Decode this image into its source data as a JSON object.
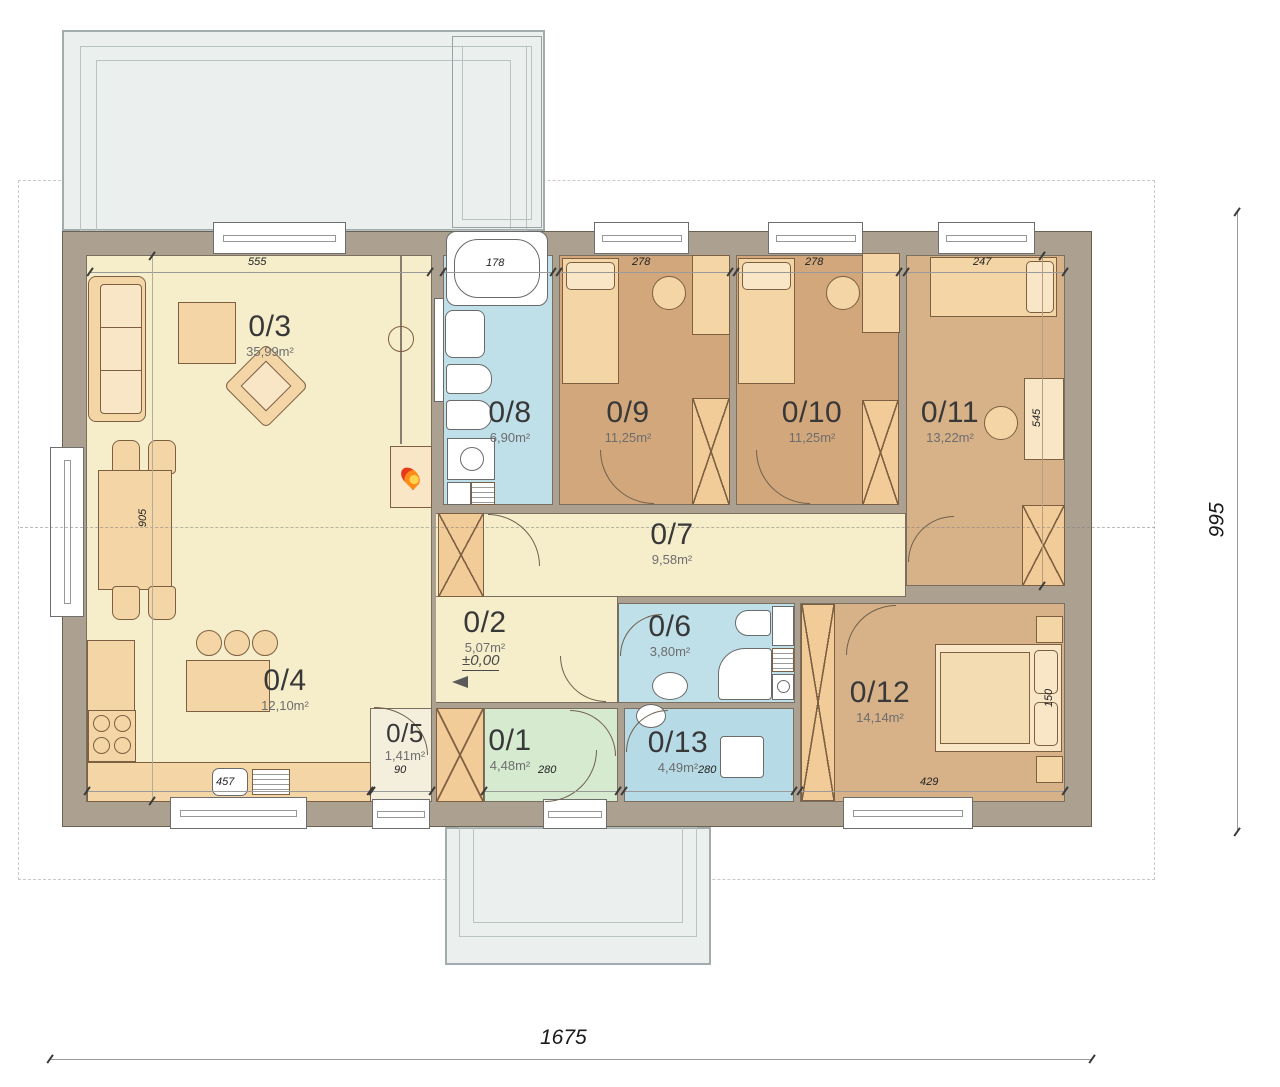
{
  "plan": {
    "title": "Single-storey house floor plan",
    "rooms": [
      {
        "id": "0/1",
        "area": "4,48m²",
        "type": "entry"
      },
      {
        "id": "0/2",
        "area": "5,07m²",
        "type": "hall"
      },
      {
        "id": "0/3",
        "area": "35,99m²",
        "type": "living-room"
      },
      {
        "id": "0/4",
        "area": "12,10m²",
        "type": "kitchen"
      },
      {
        "id": "0/5",
        "area": "1,41m²",
        "type": "closet"
      },
      {
        "id": "0/6",
        "area": "3,80m²",
        "type": "bathroom"
      },
      {
        "id": "0/7",
        "area": "9,58m²",
        "type": "corridor"
      },
      {
        "id": "0/8",
        "area": "6,90m²",
        "type": "bathroom"
      },
      {
        "id": "0/9",
        "area": "11,25m²",
        "type": "bedroom"
      },
      {
        "id": "0/10",
        "area": "11,25m²",
        "type": "bedroom"
      },
      {
        "id": "0/11",
        "area": "13,22m²",
        "type": "bedroom"
      },
      {
        "id": "0/12",
        "area": "14,14m²",
        "type": "bedroom"
      },
      {
        "id": "0/13",
        "area": "4,49m²",
        "type": "utility"
      }
    ],
    "dims": {
      "living_width": "555",
      "bath_width": "178",
      "bedroom1_width": "278",
      "bedroom2_width": "278",
      "bedroom3_width": "247",
      "dining_height": "905",
      "desk_height": "545",
      "kitchen_width": "457",
      "closet_width": "90",
      "entry_width": "280",
      "utility_width": "280",
      "bedroom4_width": "429",
      "bed_width": "150",
      "total_width": "1675",
      "total_height": "995"
    },
    "level_marker": "±0,00",
    "colors": {
      "wall": "#aca091",
      "floor_main": "#f6eecb",
      "floor_bath": "#bfdfe9",
      "floor_entry": "#d5eacf",
      "floor_bedroom": "#d2a77b",
      "terrace": "#ebefee",
      "flame_accent": "#e8391d"
    }
  }
}
